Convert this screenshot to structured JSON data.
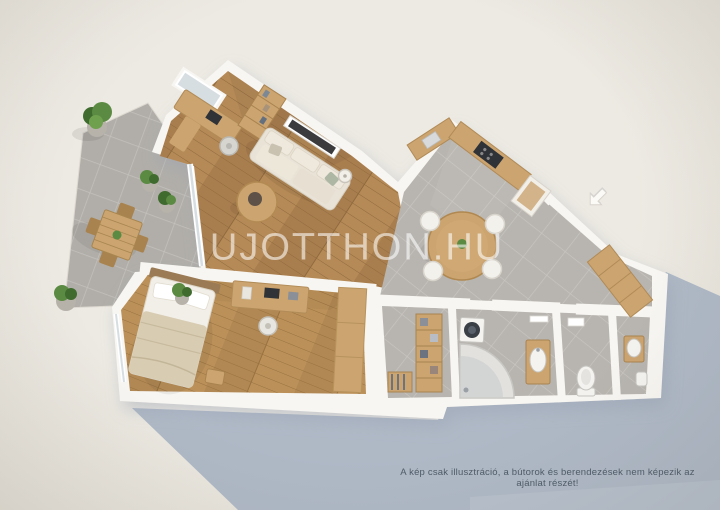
{
  "watermark": {
    "text": "UJOTTHON.HU"
  },
  "caption": {
    "text": "A kép csak illusztráció, a bútorok és berendezések nem képezik az ajánlat részét!"
  },
  "icons": {
    "entrance_arrow": "entrance-direction-arrow (white 3D arrow pointing to apartment entry)"
  },
  "scene": {
    "type": "3d-floorplan-render",
    "view": "top-down isometric, white walls, sunlight from upper right",
    "rooms": [
      {
        "name": "terrace",
        "floor": "gray stone tiles",
        "furniture": [
          "outdoor wooden table",
          "4 wooden chairs",
          "5 potted plants"
        ]
      },
      {
        "name": "living-room-with-office",
        "floor": "wood planks",
        "furniture": [
          "corner desk with laptop",
          "office chair",
          "bookshelf",
          "window",
          "beige sofa",
          "round coffee table",
          "floor lamp",
          "wall tv-radiator panel",
          "glass wall to terrace"
        ]
      },
      {
        "name": "bedroom",
        "floor": "wood planks",
        "furniture": [
          "double bed",
          "desk with laptop",
          "chair",
          "wardrobe",
          "potted plant",
          "nightstand",
          "window"
        ]
      },
      {
        "name": "kitchen-dining",
        "floor": "gray tiles",
        "furniture": [
          "L-shaped counter",
          "cooktop",
          "sink",
          "tall fridge unit",
          "round dining table",
          "4 white chairs"
        ]
      },
      {
        "name": "entrance-hall",
        "floor": "gray tiles",
        "furniture": [
          "wooden wardrobe cabinet"
        ]
      },
      {
        "name": "walk-in-closet",
        "floor": "gray tiles",
        "furniture": [
          "shelving with clothes",
          "low clothes rack"
        ]
      },
      {
        "name": "bathroom",
        "floor": "gray tiles",
        "furniture": [
          "washing machine",
          "corner bathtub",
          "vanity with basin",
          "mirror"
        ]
      },
      {
        "name": "wc",
        "floor": "gray tiles",
        "furniture": [
          "toilet",
          "wall cabinet"
        ]
      },
      {
        "name": "shower-room",
        "floor": "gray tiles",
        "furniture": [
          "washbasin",
          "small toilet unit"
        ]
      }
    ]
  },
  "colors": {
    "background": "#EDEAE3",
    "background_edge": "#E2DED5",
    "wall": "#F8F6F2",
    "wall_shade": "#E4E0D9",
    "shadow_blue": "#AFB9C6",
    "shadow_blue_light": "#C2C9D3",
    "wood_floor": "#A97F4E",
    "wood_floor_line": "#8F6A3E",
    "bedroom_floor": "#B18853",
    "bedroom_floor_line": "#97713F",
    "tile": "#B8B5B0",
    "tile_line": "#C9C6C1",
    "terrace_tile": "#B1AEA9",
    "terrace_tile_line": "#C4C1BC",
    "wood_furniture": "#CBA470",
    "wood_furniture_dark": "#A9834F",
    "sofa": "#E9E3D7",
    "cushion": "#C9C2B1",
    "bedding": "#D8CCB3",
    "linen": "#F2EFE8",
    "plant": "#5B8A42",
    "plant_dark": "#3F6B2E",
    "pot": "#B7B2AA",
    "appliance": "#2F3237",
    "fixture_white": "#F4F3F0",
    "fixture_line": "#C6C4BF",
    "glass": "#D7DEE2",
    "arrow_fill": "#FBFAF7",
    "arrow_edge": "#D8D4CC",
    "watermark_color": "rgba(255,255,255,0.58)",
    "caption_text": "#4F5B68"
  }
}
